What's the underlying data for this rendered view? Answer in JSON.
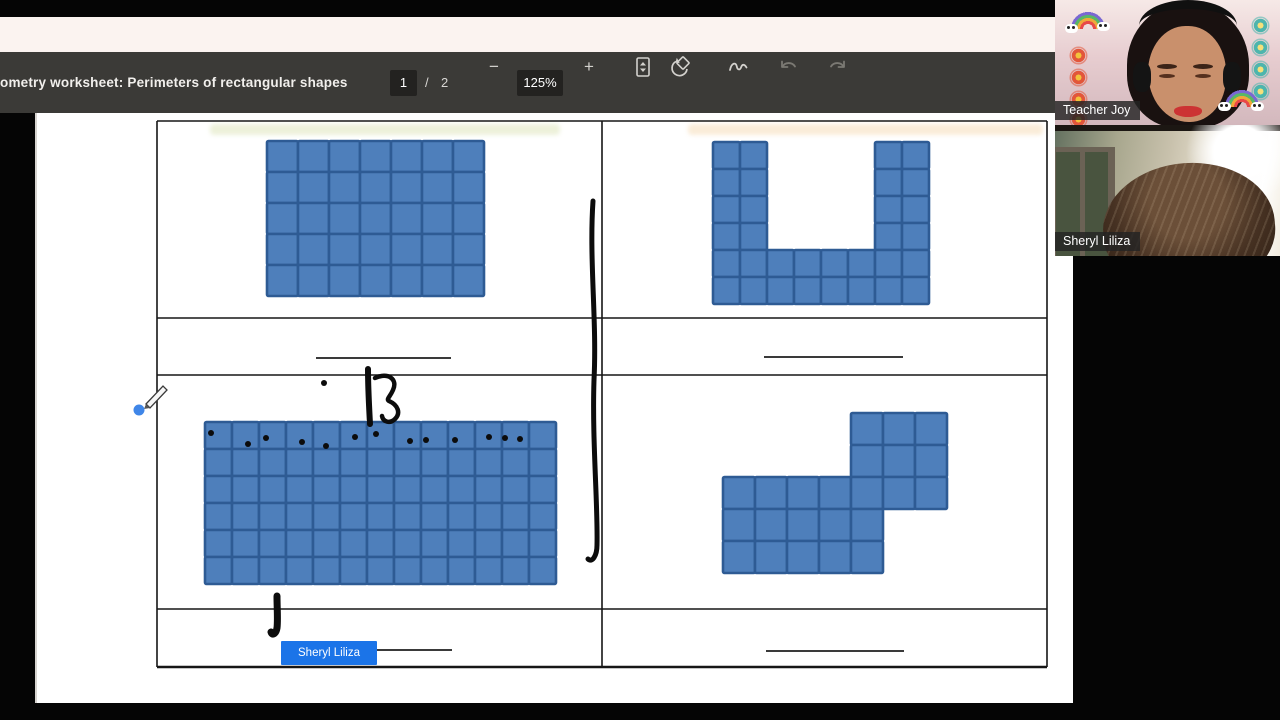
{
  "toolbar": {
    "title": "ometry worksheet: Perimeters of rectangular shapes",
    "page": {
      "current": "1",
      "separator": "/",
      "total": "2"
    },
    "zoom": {
      "out": "−",
      "level": "125%",
      "in": "+"
    },
    "icons": {
      "fit_to_page": "fit-to-page",
      "rotate": "rotate",
      "draw": "draw",
      "undo": "undo",
      "redo": "redo"
    }
  },
  "meeting": {
    "participants": [
      {
        "name": "Teacher Joy"
      },
      {
        "name": "Sheryl Liliza"
      }
    ]
  },
  "cursor_label": {
    "name": "Sheryl Liliza",
    "color": "#1b74e8"
  },
  "worksheet": {
    "square_fill": "#4e7fbb",
    "square_stroke": "#2e5b94",
    "table": {
      "line_color": "#161616",
      "x": 157,
      "y": 121,
      "w": 890,
      "h": 546,
      "divider_x": 602,
      "row_lines": [
        318,
        375,
        609
      ]
    },
    "shapes": [
      {
        "name": "rectangle-grid-7x5",
        "x": 267,
        "y": 141,
        "cell": 31,
        "mask": [
          "1111111",
          "1111111",
          "1111111",
          "1111111",
          "1111111"
        ]
      },
      {
        "name": "u-shape-grid-8x6",
        "x": 713,
        "y": 142,
        "cell": 27,
        "mask": [
          "11000011",
          "11000011",
          "11000011",
          "11000011",
          "11111111",
          "11111111"
        ]
      },
      {
        "name": "rectangle-grid-13x6",
        "x": 205,
        "y": 422,
        "cell": 27,
        "mask": [
          "1111111111111",
          "1111111111111",
          "1111111111111",
          "1111111111111",
          "1111111111111",
          "1111111111111"
        ]
      },
      {
        "name": "s-shape-grid-7x5",
        "x": 723,
        "y": 413,
        "cell": 32,
        "mask": [
          "0000111",
          "0000111",
          "1111111",
          "1111100",
          "1111100"
        ]
      }
    ],
    "answer_lines": [
      [
        316,
        358,
        451,
        358
      ],
      [
        764,
        357,
        903,
        357
      ],
      [
        333,
        650,
        452,
        650
      ],
      [
        766,
        651,
        904,
        651
      ]
    ]
  },
  "annotations": {
    "color": "#0c0c0c",
    "strokes": [
      {
        "name": "pen-long-vertical-stroke",
        "width": 5,
        "path": "M 593 201 C 589 260 597 320 594 380 C 592 440 598 505 597 545 C 597 556 592 563 588 559"
      },
      {
        "name": "pen-short-stroke",
        "width": 6,
        "path": "M 368 369 C 368 388 369 406 370 424"
      },
      {
        "name": "pen-curl-3",
        "width": 4.5,
        "path": "M 375 378 C 388 372 398 379 393 390 C 390 397 386 399 389 401 C 398 405 401 413 395 419 C 390 424 383 422 382 416"
      },
      {
        "name": "pen-bottom-tick",
        "width": 7,
        "path": "M 277 596 C 277 608 278 620 277 628 C 276 634 272 636 271 632"
      }
    ],
    "dots": [
      [
        324,
        383
      ],
      [
        211,
        433
      ],
      [
        248,
        444
      ],
      [
        266,
        438
      ],
      [
        302,
        442
      ],
      [
        326,
        446
      ],
      [
        355,
        437
      ],
      [
        376,
        434
      ],
      [
        410,
        441
      ],
      [
        426,
        440
      ],
      [
        455,
        440
      ],
      [
        489,
        437
      ],
      [
        505,
        438
      ],
      [
        520,
        439
      ]
    ]
  },
  "pen_cursor": {
    "x": 139,
    "y": 410,
    "dot_color": "#3f86e8"
  }
}
